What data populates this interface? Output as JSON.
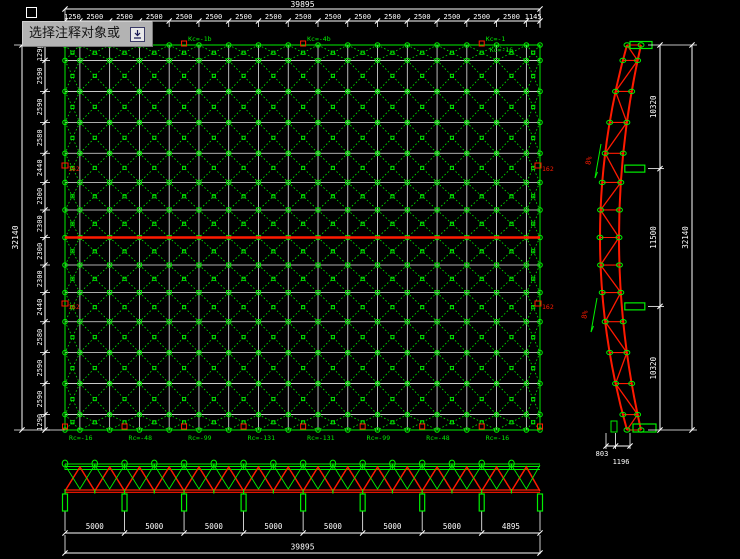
{
  "app": {
    "tooltip_text": "选择注释对象或",
    "tooltip_icon": "tab-key-icon"
  },
  "colors": {
    "background": "#000000",
    "member_green": "#00ee00",
    "member_red": "#ff1a00",
    "grid_white": "#e6e6e6",
    "dim_white": "#ffffff",
    "tooltip_grey": "#b3b3b3"
  },
  "plan": {
    "overall_width": "39895",
    "overall_height": "32140",
    "top_segments": [
      "1250",
      "2500",
      "2500",
      "2500",
      "2500",
      "2500",
      "2500",
      "2500",
      "2500",
      "2500",
      "2500",
      "2500",
      "2500",
      "2500",
      "2500",
      "2500",
      "1145"
    ],
    "left_segments": [
      "1290",
      "2590",
      "2590",
      "2580",
      "2440",
      "2300",
      "2300",
      "2300",
      "2300",
      "2440",
      "2580",
      "2590",
      "2590",
      "1290"
    ],
    "bottom_edge_labels": [
      "Rc=-16",
      "Rc=-48",
      "Rc=-99",
      "Rc=-131",
      "Rc=-131",
      "Rc=-99",
      "Rc=-48",
      "Rc=-16"
    ],
    "top_edge_labels": [
      "Kc=-1b",
      "Kc=-4b",
      "Kc=-1",
      "Kc=-16"
    ],
    "red_edge_labels": [
      "162",
      "162",
      "162",
      "162"
    ]
  },
  "side_elevation": {
    "segments": [
      "10320",
      "11500",
      "10320"
    ],
    "overall": "32140",
    "bottom_dims": [
      "803",
      "1196"
    ],
    "slope_labels": [
      "8%",
      "8%"
    ]
  },
  "bottom_elevation": {
    "segments": [
      "5000",
      "5000",
      "5000",
      "5000",
      "5000",
      "5000",
      "5000",
      "4895"
    ],
    "overall": "39895"
  }
}
